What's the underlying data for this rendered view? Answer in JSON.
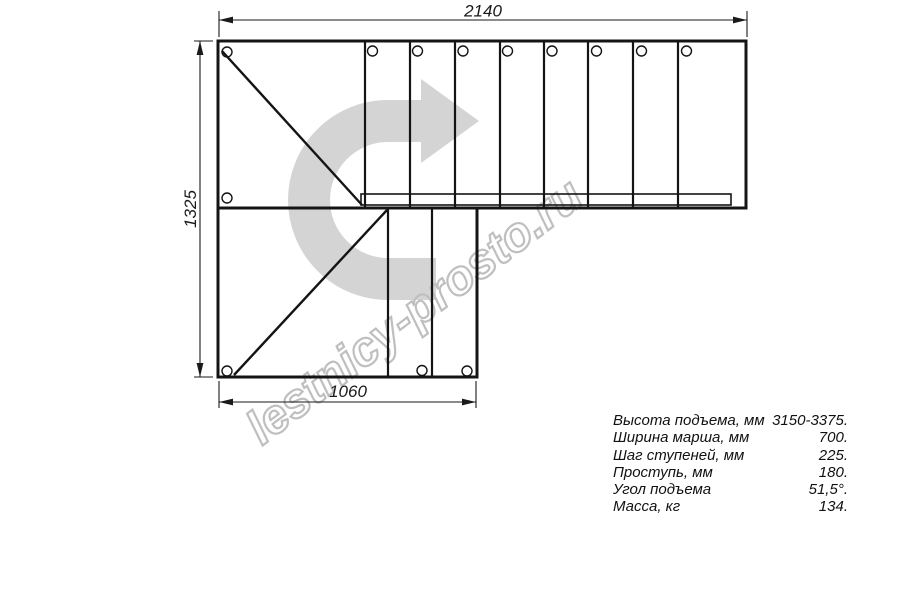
{
  "watermark": "lestnicy-prosto.ru",
  "drawing": {
    "dim_top": "2140",
    "dim_left": "1325",
    "dim_bottom": "1060",
    "icons": {
      "direction_arrow": "curved-right-arrow",
      "holes": "mounting-hole-circles"
    }
  },
  "specs": {
    "rows": [
      {
        "label": "Высота подъема, мм",
        "value": "3150-3375."
      },
      {
        "label": "Ширина марша, мм",
        "value": "700."
      },
      {
        "label": "Шаг ступеней, мм",
        "value": "225."
      },
      {
        "label": "Проступь, мм",
        "value": "180."
      },
      {
        "label": "Угол подъема",
        "value": "51,5°."
      },
      {
        "label": "Масса, кг",
        "value": "134."
      }
    ]
  },
  "colors": {
    "background": "#ffffff",
    "line": "#141414",
    "dimension_line": "#1a1a1a",
    "arrow": "#d4d4d4",
    "watermark_outline": "#bfbfbf"
  }
}
